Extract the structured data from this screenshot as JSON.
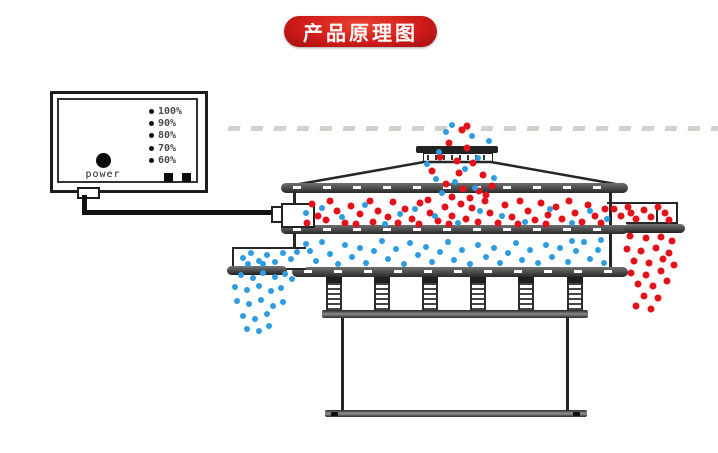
{
  "banner": {
    "label": "产品原理图"
  },
  "control_box": {
    "power_label": "power",
    "levels": [
      "100%",
      "90%",
      "80%",
      "70%",
      "60%"
    ],
    "indicator_squares": [
      "square",
      "square"
    ]
  },
  "colors": {
    "banner_red": "#c3151a",
    "coarse_particle_red": "#e3121a",
    "fine_particle_blue": "#2e9ce0",
    "line_dark": "#262626",
    "band_gray": "#4a4a4a"
  },
  "machine": {
    "springs_cx": [
      334,
      382,
      430,
      478,
      526,
      575
    ]
  },
  "particles": {
    "inlet-stream-coarse": {
      "color": "red",
      "points": [
        [
          467,
          126
        ],
        [
          462,
          130
        ],
        [
          449,
          143
        ],
        [
          467,
          148
        ],
        [
          440,
          157
        ],
        [
          457,
          161
        ],
        [
          473,
          163
        ],
        [
          432,
          171
        ],
        [
          459,
          173
        ],
        [
          483,
          175
        ],
        [
          446,
          184
        ],
        [
          463,
          189
        ],
        [
          479,
          191
        ],
        [
          452,
          197
        ],
        [
          486,
          195
        ],
        [
          470,
          198
        ],
        [
          492,
          186
        ]
      ]
    },
    "inlet-stream-fine": {
      "color": "blue",
      "points": [
        [
          452,
          125
        ],
        [
          446,
          132
        ],
        [
          472,
          136
        ],
        [
          489,
          141
        ],
        [
          439,
          152
        ],
        [
          478,
          158
        ],
        [
          427,
          164
        ],
        [
          465,
          169
        ],
        [
          436,
          179
        ],
        [
          455,
          182
        ],
        [
          494,
          178
        ],
        [
          442,
          193
        ],
        [
          475,
          188
        ]
      ]
    },
    "upper-chamber-coarse": {
      "color": "red",
      "points": [
        [
          312,
          204
        ],
        [
          318,
          216
        ],
        [
          307,
          223
        ],
        [
          330,
          201
        ],
        [
          337,
          211
        ],
        [
          326,
          220
        ],
        [
          345,
          223
        ],
        [
          351,
          206
        ],
        [
          360,
          214
        ],
        [
          356,
          224
        ],
        [
          370,
          201
        ],
        [
          378,
          211
        ],
        [
          373,
          222
        ],
        [
          388,
          217
        ],
        [
          393,
          202
        ],
        [
          398,
          223
        ],
        [
          405,
          209
        ],
        [
          412,
          219
        ],
        [
          420,
          203
        ],
        [
          419,
          224
        ],
        [
          430,
          213
        ],
        [
          428,
          200
        ],
        [
          438,
          221
        ],
        [
          445,
          207
        ],
        [
          452,
          216
        ],
        [
          449,
          224
        ],
        [
          461,
          204
        ],
        [
          466,
          219
        ],
        [
          472,
          208
        ],
        [
          478,
          222
        ],
        [
          485,
          201
        ],
        [
          490,
          213
        ],
        [
          498,
          223
        ],
        [
          505,
          205
        ],
        [
          512,
          217
        ],
        [
          520,
          201
        ],
        [
          518,
          224
        ],
        [
          528,
          211
        ],
        [
          535,
          220
        ],
        [
          541,
          203
        ],
        [
          548,
          215
        ],
        [
          546,
          224
        ],
        [
          556,
          207
        ],
        [
          562,
          219
        ],
        [
          569,
          201
        ],
        [
          575,
          213
        ],
        [
          582,
          222
        ],
        [
          588,
          205
        ],
        [
          595,
          216
        ],
        [
          601,
          223
        ],
        [
          605,
          209
        ]
      ]
    },
    "upper-chamber-fine": {
      "color": "blue",
      "points": [
        [
          306,
          213
        ],
        [
          322,
          208
        ],
        [
          342,
          217
        ],
        [
          365,
          205
        ],
        [
          385,
          224
        ],
        [
          400,
          214
        ],
        [
          415,
          209
        ],
        [
          435,
          216
        ],
        [
          458,
          223
        ],
        [
          480,
          211
        ],
        [
          502,
          216
        ],
        [
          525,
          222
        ],
        [
          550,
          209
        ],
        [
          572,
          223
        ],
        [
          590,
          211
        ],
        [
          607,
          219
        ]
      ]
    },
    "oversize-spout-coarse": {
      "color": "red",
      "points": [
        [
          614,
          209
        ],
        [
          621,
          216
        ],
        [
          628,
          207
        ],
        [
          636,
          219
        ],
        [
          644,
          210
        ],
        [
          651,
          217
        ],
        [
          658,
          207
        ],
        [
          665,
          213
        ],
        [
          669,
          220
        ],
        [
          631,
          213
        ]
      ]
    },
    "oversize-discharge-coarse": {
      "color": "red",
      "points": [
        [
          630,
          236
        ],
        [
          646,
          238
        ],
        [
          661,
          237
        ],
        [
          672,
          241
        ],
        [
          627,
          249
        ],
        [
          641,
          251
        ],
        [
          656,
          248
        ],
        [
          669,
          253
        ],
        [
          634,
          261
        ],
        [
          649,
          263
        ],
        [
          663,
          259
        ],
        [
          674,
          265
        ],
        [
          631,
          273
        ],
        [
          646,
          275
        ],
        [
          661,
          271
        ],
        [
          638,
          284
        ],
        [
          653,
          286
        ],
        [
          667,
          281
        ],
        [
          644,
          296
        ],
        [
          658,
          298
        ],
        [
          636,
          306
        ],
        [
          651,
          309
        ]
      ]
    },
    "lower-chamber-fine": {
      "color": "blue",
      "points": [
        [
          306,
          244
        ],
        [
          310,
          251
        ],
        [
          316,
          261
        ],
        [
          322,
          242
        ],
        [
          330,
          254
        ],
        [
          338,
          264
        ],
        [
          345,
          245
        ],
        [
          352,
          257
        ],
        [
          360,
          248
        ],
        [
          366,
          263
        ],
        [
          374,
          251
        ],
        [
          382,
          241
        ],
        [
          388,
          259
        ],
        [
          396,
          249
        ],
        [
          404,
          264
        ],
        [
          410,
          243
        ],
        [
          418,
          255
        ],
        [
          426,
          247
        ],
        [
          432,
          262
        ],
        [
          440,
          252
        ],
        [
          448,
          242
        ],
        [
          454,
          260
        ],
        [
          462,
          250
        ],
        [
          470,
          264
        ],
        [
          478,
          245
        ],
        [
          486,
          257
        ],
        [
          494,
          248
        ],
        [
          500,
          263
        ],
        [
          508,
          253
        ],
        [
          516,
          243
        ],
        [
          522,
          260
        ],
        [
          530,
          250
        ],
        [
          538,
          263
        ],
        [
          546,
          245
        ],
        [
          552,
          257
        ],
        [
          560,
          248
        ],
        [
          568,
          262
        ],
        [
          576,
          251
        ],
        [
          584,
          242
        ],
        [
          590,
          259
        ],
        [
          598,
          250
        ],
        [
          604,
          263
        ],
        [
          572,
          241
        ],
        [
          601,
          240
        ]
      ]
    },
    "fines-spout-fine": {
      "color": "blue",
      "points": [
        [
          243,
          258
        ],
        [
          251,
          253
        ],
        [
          259,
          261
        ],
        [
          267,
          255
        ],
        [
          275,
          262
        ],
        [
          283,
          253
        ],
        [
          291,
          259
        ],
        [
          297,
          252
        ],
        [
          263,
          264
        ],
        [
          248,
          264
        ]
      ]
    },
    "fines-discharge-fine": {
      "color": "blue",
      "points": [
        [
          241,
          275
        ],
        [
          253,
          278
        ],
        [
          263,
          273
        ],
        [
          275,
          277
        ],
        [
          285,
          274
        ],
        [
          292,
          279
        ],
        [
          235,
          287
        ],
        [
          247,
          290
        ],
        [
          259,
          286
        ],
        [
          271,
          291
        ],
        [
          281,
          288
        ],
        [
          237,
          301
        ],
        [
          249,
          304
        ],
        [
          261,
          300
        ],
        [
          273,
          306
        ],
        [
          283,
          302
        ],
        [
          243,
          316
        ],
        [
          255,
          319
        ],
        [
          267,
          314
        ],
        [
          247,
          329
        ],
        [
          259,
          331
        ],
        [
          269,
          326
        ]
      ]
    }
  }
}
